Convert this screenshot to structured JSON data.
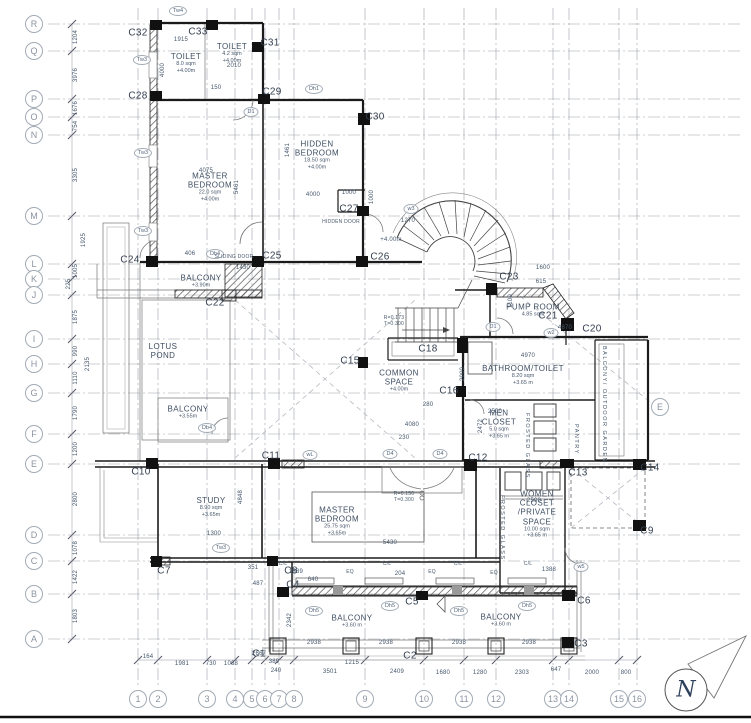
{
  "north": {
    "label": "N"
  },
  "grid": {
    "bubbles": [
      {
        "label": "R",
        "x": 34,
        "y": 24
      },
      {
        "label": "Q",
        "x": 34,
        "y": 51
      },
      {
        "label": "P",
        "x": 34,
        "y": 99
      },
      {
        "label": "O",
        "x": 34,
        "y": 117
      },
      {
        "label": "N",
        "x": 34,
        "y": 135
      },
      {
        "label": "M",
        "x": 34,
        "y": 216
      },
      {
        "label": "L",
        "x": 34,
        "y": 264
      },
      {
        "label": "K",
        "x": 34,
        "y": 279
      },
      {
        "label": "J",
        "x": 34,
        "y": 295
      },
      {
        "label": "I",
        "x": 34,
        "y": 339
      },
      {
        "label": "H",
        "x": 34,
        "y": 364
      },
      {
        "label": "G",
        "x": 34,
        "y": 393
      },
      {
        "label": "F",
        "x": 34,
        "y": 434
      },
      {
        "label": "E",
        "x": 34,
        "y": 464
      },
      {
        "label": "D",
        "x": 34,
        "y": 535
      },
      {
        "label": "C",
        "x": 34,
        "y": 561
      },
      {
        "label": "B",
        "x": 34,
        "y": 594
      },
      {
        "label": "A",
        "x": 34,
        "y": 639
      },
      {
        "label": "1",
        "x": 138,
        "y": 699
      },
      {
        "label": "2",
        "x": 158,
        "y": 699
      },
      {
        "label": "3",
        "x": 207,
        "y": 699
      },
      {
        "label": "4",
        "x": 235,
        "y": 699
      },
      {
        "label": "5",
        "x": 252,
        "y": 699
      },
      {
        "label": "6",
        "x": 265,
        "y": 699
      },
      {
        "label": "7",
        "x": 279,
        "y": 699
      },
      {
        "label": "8",
        "x": 294,
        "y": 699
      },
      {
        "label": "9",
        "x": 365,
        "y": 699
      },
      {
        "label": "10",
        "x": 424,
        "y": 699
      },
      {
        "label": "11",
        "x": 464,
        "y": 699
      },
      {
        "label": "12",
        "x": 496,
        "y": 699
      },
      {
        "label": "13",
        "x": 553,
        "y": 699
      },
      {
        "label": "14",
        "x": 569,
        "y": 699
      },
      {
        "label": "15",
        "x": 619,
        "y": 699
      },
      {
        "label": "16",
        "x": 637,
        "y": 699
      },
      {
        "label": "E",
        "x": 660,
        "y": 407,
        "section": true
      }
    ]
  },
  "columns": [
    {
      "t": "C32",
      "x": 138,
      "y": 33
    },
    {
      "t": "C33",
      "x": 198,
      "y": 32
    },
    {
      "t": "C31",
      "x": 270,
      "y": 43
    },
    {
      "t": "C28",
      "x": 138,
      "y": 96
    },
    {
      "t": "C29",
      "x": 272,
      "y": 92
    },
    {
      "t": "C30",
      "x": 375,
      "y": 117
    },
    {
      "t": "C27",
      "x": 349,
      "y": 209
    },
    {
      "t": "C24",
      "x": 130,
      "y": 260
    },
    {
      "t": "C25",
      "x": 272,
      "y": 256
    },
    {
      "t": "C26",
      "x": 380,
      "y": 257
    },
    {
      "t": "C22",
      "x": 215,
      "y": 303
    },
    {
      "t": "C23",
      "x": 509,
      "y": 277
    },
    {
      "t": "C21",
      "x": 548,
      "y": 316
    },
    {
      "t": "C20",
      "x": 592,
      "y": 329
    },
    {
      "t": "C18",
      "x": 428,
      "y": 349
    },
    {
      "t": "C15",
      "x": 350,
      "y": 361
    },
    {
      "t": "C16",
      "x": 449,
      "y": 391
    },
    {
      "t": "C12",
      "x": 478,
      "y": 458
    },
    {
      "t": "C13",
      "x": 578,
      "y": 473
    },
    {
      "t": "C14",
      "x": 650,
      "y": 468
    },
    {
      "t": "C9",
      "x": 647,
      "y": 531
    },
    {
      "t": "C10",
      "x": 141,
      "y": 472
    },
    {
      "t": "C11",
      "x": 271,
      "y": 456
    },
    {
      "t": "C7",
      "x": 164,
      "y": 571
    },
    {
      "t": "C8",
      "x": 291,
      "y": 571
    },
    {
      "t": "C4",
      "x": 293,
      "y": 585
    },
    {
      "t": "C5",
      "x": 412,
      "y": 602
    },
    {
      "t": "C6",
      "x": 584,
      "y": 601
    },
    {
      "t": "C3",
      "x": 581,
      "y": 644
    },
    {
      "t": "C2",
      "x": 410,
      "y": 656
    },
    {
      "t": "C1",
      "x": 259,
      "y": 654
    }
  ],
  "rooms": [
    {
      "name": "TOILET",
      "area": "8.0 sqm",
      "level": "+4.00m",
      "x": 186,
      "y": 63,
      "w": 46
    },
    {
      "name": "TOILET",
      "area": "4.2 sqm",
      "level": "+4.00m",
      "x": 232,
      "y": 53,
      "w": 40
    },
    {
      "name": "HIDDEN BEDROOM",
      "area": "18.50 sqm",
      "level": "+4.00m",
      "x": 317,
      "y": 155,
      "w": 70
    },
    {
      "name": "MASTER BEDROOM",
      "area": "22.0 sqm",
      "level": "+4.00m",
      "x": 210,
      "y": 187,
      "w": 80
    },
    {
      "name": "BALCONY",
      "area": "",
      "level": "+3.90m",
      "x": 201,
      "y": 281,
      "w": 60
    },
    {
      "name": "LOTUS POND",
      "area": "",
      "level": "",
      "x": 163,
      "y": 351,
      "w": 40
    },
    {
      "name": "BALCONY",
      "area": "",
      "level": "+3.55m",
      "x": 188,
      "y": 412,
      "w": 50
    },
    {
      "name": "COMMON SPACE",
      "area": "",
      "level": "+4.00m",
      "x": 399,
      "y": 381,
      "w": 60
    },
    {
      "name": "BATHROOM/TOILET",
      "area": "8.20 sqm",
      "level": "+3.65 m",
      "x": 523,
      "y": 375,
      "w": 110
    },
    {
      "name": "MEN CLOSET",
      "area": "5.0 sqm",
      "level": "+3.65 m",
      "x": 499,
      "y": 424,
      "w": 46
    },
    {
      "name": "STUDY",
      "area": "8.90 sqm",
      "level": "+3.65m",
      "x": 211,
      "y": 507,
      "w": 50
    },
    {
      "name": "MASTER BEDROOM",
      "area": "25.75 sqm",
      "level": "+3.65m",
      "x": 337,
      "y": 521,
      "w": 80
    },
    {
      "name": "WOMEN CLOSET /PRIVATE SPACE",
      "area": "10.00 sqm",
      "level": "+3.65 m",
      "x": 537,
      "y": 514,
      "w": 52
    },
    {
      "name": "PUMP ROOM",
      "area": "4.85 sqm",
      "level": "",
      "x": 533,
      "y": 310,
      "w": 60
    },
    {
      "name": "BALCONY",
      "area": "",
      "level": "+3.60 m",
      "x": 352,
      "y": 621,
      "w": 70
    },
    {
      "name": "BALCONY",
      "area": "",
      "level": "+3.60 m",
      "x": 501,
      "y": 620,
      "w": 70
    }
  ],
  "markers": [
    {
      "t": "Tw4",
      "x": 178,
      "y": 11
    },
    {
      "t": "Tw3",
      "x": 142,
      "y": 60
    },
    {
      "t": "Tw3",
      "x": 143,
      "y": 153
    },
    {
      "t": "Tw3",
      "x": 143,
      "y": 231
    },
    {
      "t": "Tw3",
      "x": 221,
      "y": 548
    },
    {
      "t": "Dh1",
      "x": 314,
      "y": 89
    },
    {
      "t": "D1",
      "x": 251,
      "y": 112
    },
    {
      "t": "w3",
      "x": 411,
      "y": 209
    },
    {
      "t": "Db4",
      "x": 215,
      "y": 254
    },
    {
      "t": "Db4",
      "x": 207,
      "y": 428
    },
    {
      "t": "D1",
      "x": 493,
      "y": 327
    },
    {
      "t": "w2",
      "x": 551,
      "y": 333
    },
    {
      "t": "D4",
      "x": 390,
      "y": 454
    },
    {
      "t": "D4",
      "x": 440,
      "y": 454
    },
    {
      "t": "wL",
      "x": 310,
      "y": 455
    },
    {
      "t": "w5",
      "x": 581,
      "y": 567
    },
    {
      "t": "Dh5",
      "x": 314,
      "y": 611
    },
    {
      "t": "Dh5",
      "x": 390,
      "y": 606
    },
    {
      "t": "Dh5",
      "x": 459,
      "y": 611
    },
    {
      "t": "Dh5",
      "x": 527,
      "y": 606
    }
  ],
  "dims": [
    {
      "t": "1204",
      "x": 76,
      "y": 37,
      "v": 1
    },
    {
      "t": "3976",
      "x": 76,
      "y": 75,
      "v": 1
    },
    {
      "t": "1676",
      "x": 76,
      "y": 108,
      "v": 1
    },
    {
      "t": "754",
      "x": 76,
      "y": 126,
      "v": 1
    },
    {
      "t": "3305",
      "x": 76,
      "y": 175,
      "v": 1
    },
    {
      "t": "1925",
      "x": 84,
      "y": 240,
      "v": 1
    },
    {
      "t": "1005",
      "x": 76,
      "y": 271,
      "v": 1
    },
    {
      "t": "225",
      "x": 69,
      "y": 284,
      "v": 1
    },
    {
      "t": "1875",
      "x": 76,
      "y": 317,
      "v": 1
    },
    {
      "t": "990",
      "x": 76,
      "y": 351,
      "v": 1
    },
    {
      "t": "1110",
      "x": 76,
      "y": 378,
      "v": 1
    },
    {
      "t": "1790",
      "x": 76,
      "y": 413,
      "v": 1
    },
    {
      "t": "1200",
      "x": 76,
      "y": 449,
      "v": 1
    },
    {
      "t": "2800",
      "x": 76,
      "y": 499,
      "v": 1
    },
    {
      "t": "1078",
      "x": 76,
      "y": 548,
      "v": 1
    },
    {
      "t": "1422",
      "x": 76,
      "y": 577,
      "v": 1
    },
    {
      "t": "1803",
      "x": 76,
      "y": 616,
      "v": 1
    },
    {
      "t": "2135",
      "x": 88,
      "y": 364,
      "v": 1
    },
    {
      "t": "164",
      "x": 148,
      "y": 657
    },
    {
      "t": "1981",
      "x": 182,
      "y": 664
    },
    {
      "t": "730",
      "x": 211,
      "y": 664
    },
    {
      "t": "1068",
      "x": 231,
      "y": 664
    },
    {
      "t": "2667",
      "x": 259,
      "y": 654
    },
    {
      "t": "389",
      "x": 274,
      "y": 662
    },
    {
      "t": "240",
      "x": 276,
      "y": 671
    },
    {
      "t": "3501",
      "x": 330,
      "y": 672
    },
    {
      "t": "1215",
      "x": 352,
      "y": 663
    },
    {
      "t": "2409",
      "x": 397,
      "y": 672
    },
    {
      "t": "1680",
      "x": 443,
      "y": 673
    },
    {
      "t": "1280",
      "x": 480,
      "y": 673
    },
    {
      "t": "2303",
      "x": 522,
      "y": 673
    },
    {
      "t": "647",
      "x": 556,
      "y": 670
    },
    {
      "t": "2000",
      "x": 592,
      "y": 673
    },
    {
      "t": "800",
      "x": 626,
      "y": 673
    },
    {
      "t": "1915",
      "x": 181,
      "y": 40
    },
    {
      "t": "2010",
      "x": 234,
      "y": 66
    },
    {
      "t": "150",
      "x": 216,
      "y": 88
    },
    {
      "t": "4000",
      "x": 163,
      "y": 70,
      "v": 1
    },
    {
      "t": "4075",
      "x": 206,
      "y": 171
    },
    {
      "t": "4000",
      "x": 313,
      "y": 195
    },
    {
      "t": "1000",
      "x": 349,
      "y": 193
    },
    {
      "t": "1000",
      "x": 372,
      "y": 197,
      "v": 1
    },
    {
      "t": "1270",
      "x": 408,
      "y": 221
    },
    {
      "t": "+4.00m",
      "x": 391,
      "y": 240
    },
    {
      "t": "1430",
      "x": 243,
      "y": 268
    },
    {
      "t": "406",
      "x": 190,
      "y": 254
    },
    {
      "t": "5461",
      "x": 237,
      "y": 187,
      "v": 1
    },
    {
      "t": "1461",
      "x": 288,
      "y": 150,
      "v": 1
    },
    {
      "t": "1600",
      "x": 543,
      "y": 268
    },
    {
      "t": "615",
      "x": 541,
      "y": 282
    },
    {
      "t": "1100",
      "x": 511,
      "y": 301,
      "v": 1
    },
    {
      "t": "4970",
      "x": 528,
      "y": 356
    },
    {
      "t": "4870",
      "x": 565,
      "y": 328
    },
    {
      "t": "2500",
      "x": 495,
      "y": 412
    },
    {
      "t": "280",
      "x": 428,
      "y": 405
    },
    {
      "t": "4080",
      "x": 412,
      "y": 425
    },
    {
      "t": "230",
      "x": 404,
      "y": 438
    },
    {
      "t": "2472",
      "x": 481,
      "y": 426,
      "v": 1
    },
    {
      "t": "2000",
      "x": 463,
      "y": 374,
      "v": 1
    },
    {
      "t": "2500",
      "x": 534,
      "y": 501
    },
    {
      "t": "5430",
      "x": 390,
      "y": 543
    },
    {
      "t": "1300",
      "x": 214,
      "y": 534
    },
    {
      "t": "4848",
      "x": 241,
      "y": 497,
      "v": 1
    },
    {
      "t": "1389",
      "x": 296,
      "y": 572
    },
    {
      "t": "640",
      "x": 313,
      "y": 580
    },
    {
      "t": "351",
      "x": 253,
      "y": 568
    },
    {
      "t": "487",
      "x": 258,
      "y": 584
    },
    {
      "t": "2342",
      "x": 290,
      "y": 620,
      "v": 1
    },
    {
      "t": "2938",
      "x": 314,
      "y": 643
    },
    {
      "t": "2938",
      "x": 386,
      "y": 643
    },
    {
      "t": "2938",
      "x": 459,
      "y": 643
    },
    {
      "t": "2938",
      "x": 529,
      "y": 643
    },
    {
      "t": "204",
      "x": 400,
      "y": 574
    },
    {
      "t": "1388",
      "x": 549,
      "y": 570
    }
  ],
  "notes": [
    {
      "t": "HIDDEN DOOR",
      "x": 341,
      "y": 222
    },
    {
      "t": "SLIDING DOOR",
      "x": 234,
      "y": 257
    },
    {
      "t": "R=0.173",
      "x": 394,
      "y": 318
    },
    {
      "t": "T=0.300",
      "x": 394,
      "y": 324
    },
    {
      "t": "R=0.150",
      "x": 404,
      "y": 494
    },
    {
      "t": "T=0.300",
      "x": 404,
      "y": 500
    },
    {
      "t": "C/L",
      "x": 283,
      "y": 564
    },
    {
      "t": "C/L",
      "x": 387,
      "y": 564
    },
    {
      "t": "C/L",
      "x": 458,
      "y": 564
    },
    {
      "t": "C/L",
      "x": 528,
      "y": 564
    },
    {
      "t": "EQ",
      "x": 350,
      "y": 572
    },
    {
      "t": "EQ",
      "x": 432,
      "y": 572
    },
    {
      "t": "EQ",
      "x": 494,
      "y": 573
    }
  ],
  "vlabels": [
    {
      "t": "BALCONY/ OUTDOOR GARDEN",
      "x": 604,
      "y": 346
    },
    {
      "t": "PANTRY",
      "x": 576,
      "y": 424
    },
    {
      "t": "FROSTED GLASS",
      "x": 527,
      "y": 413
    },
    {
      "t": "FROSTED GLASS",
      "x": 502,
      "y": 495
    }
  ]
}
